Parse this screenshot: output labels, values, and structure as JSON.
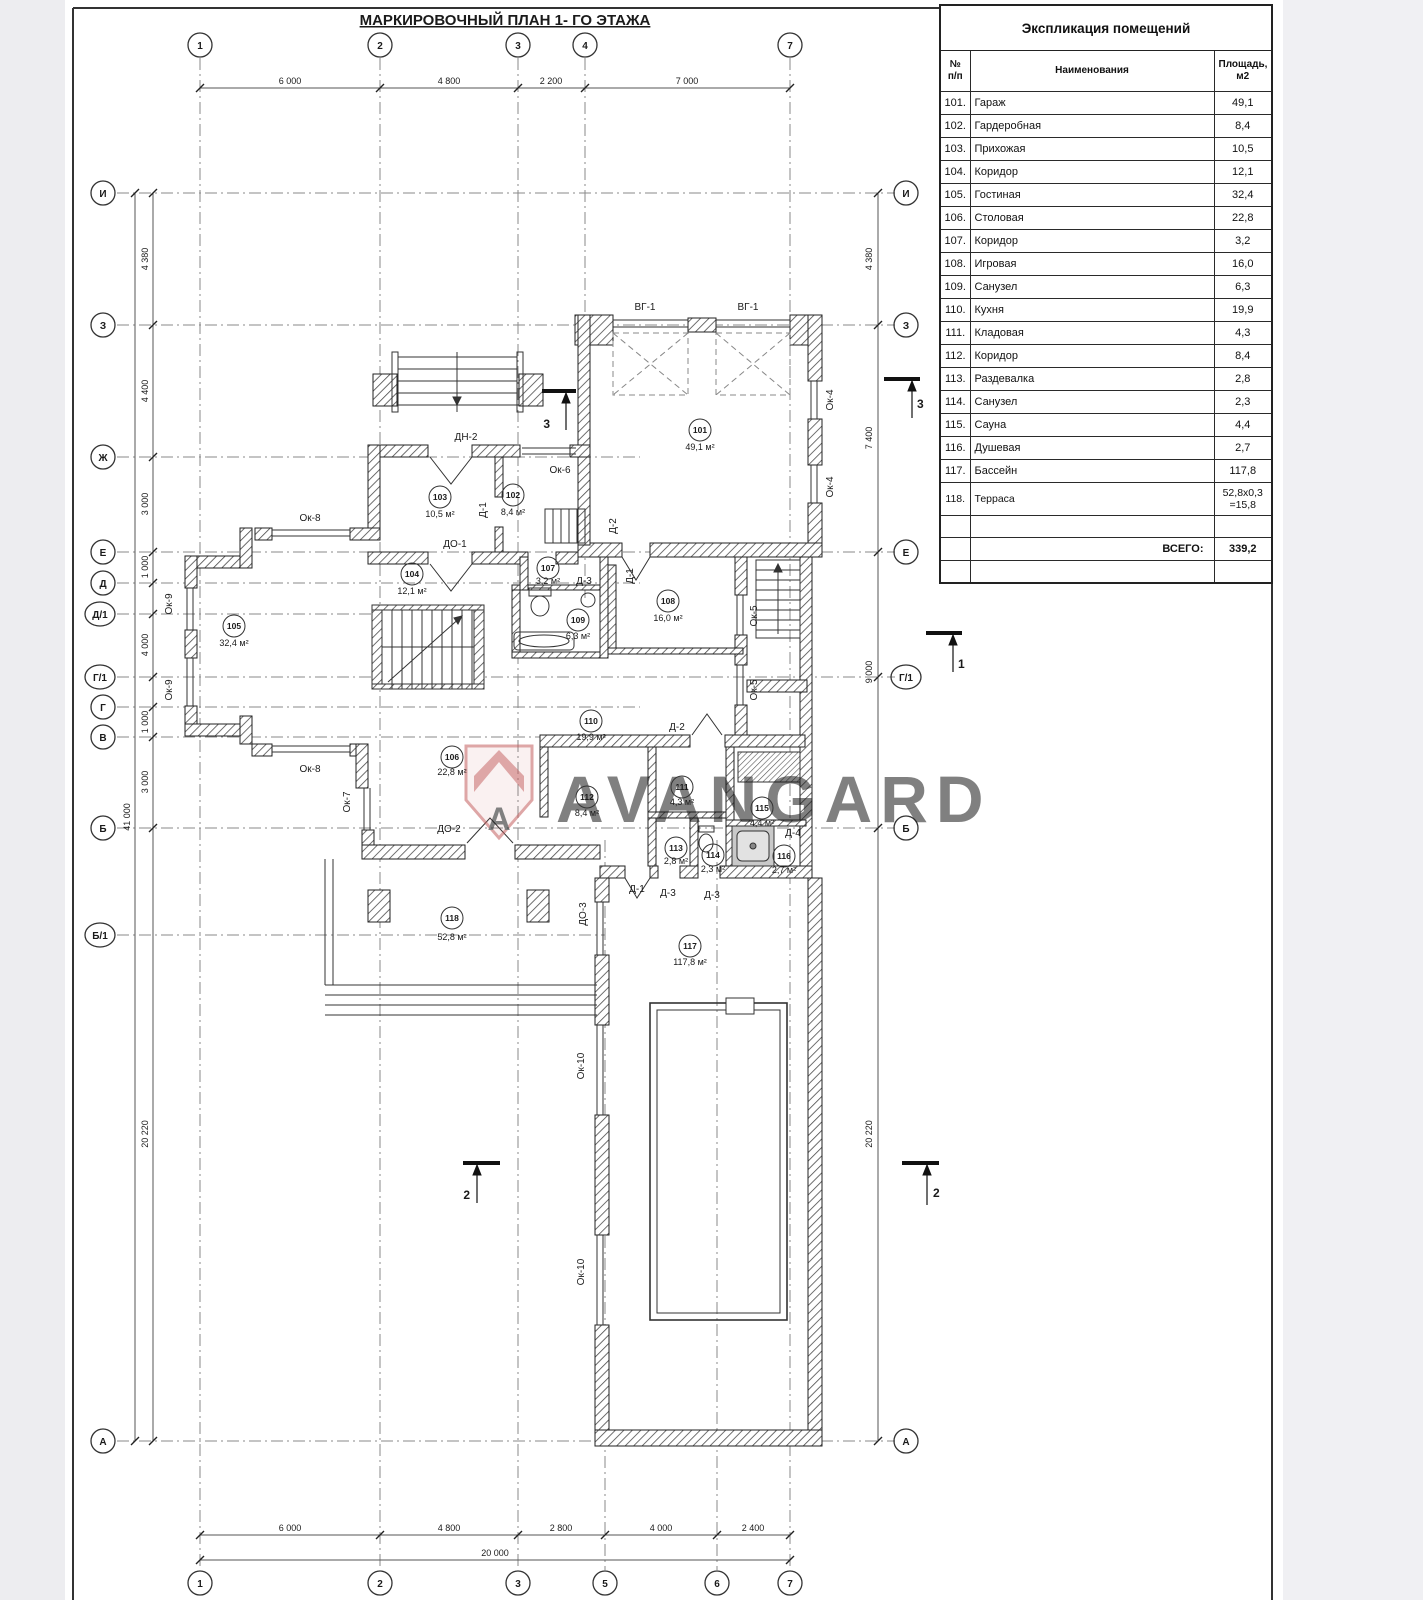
{
  "sheet": {
    "title": "МАРКИРОВОЧНЫЙ ПЛАН  1- ГО ЭТАЖА"
  },
  "watermark": {
    "text": "AVANGARD",
    "logo_letter": "А",
    "color": "#c45e5e"
  },
  "table": {
    "title": "Экспликация помещений",
    "headers": {
      "num": "№\nп/п",
      "name": "Наименования",
      "area": "Площадь,\nм2"
    },
    "rows": [
      {
        "num": "101.",
        "name": "Гараж",
        "area": "49,1"
      },
      {
        "num": "102.",
        "name": "Гардеробная",
        "area": "8,4"
      },
      {
        "num": "103.",
        "name": "Прихожая",
        "area": "10,5"
      },
      {
        "num": "104.",
        "name": "Коридор",
        "area": "12,1"
      },
      {
        "num": "105.",
        "name": "Гостиная",
        "area": "32,4"
      },
      {
        "num": "106.",
        "name": "Столовая",
        "area": "22,8"
      },
      {
        "num": "107.",
        "name": "Коридор",
        "area": "3,2"
      },
      {
        "num": "108.",
        "name": "Игровая",
        "area": "16,0"
      },
      {
        "num": "109.",
        "name": "Санузел",
        "area": "6,3"
      },
      {
        "num": "110.",
        "name": "Кухня",
        "area": "19,9"
      },
      {
        "num": "111.",
        "name": "Кладовая",
        "area": "4,3"
      },
      {
        "num": "112.",
        "name": "Коридор",
        "area": "8,4"
      },
      {
        "num": "113.",
        "name": "Раздевалка",
        "area": "2,8"
      },
      {
        "num": "114.",
        "name": "Санузел",
        "area": "2,3"
      },
      {
        "num": "115.",
        "name": "Сауна",
        "area": "4,4"
      },
      {
        "num": "116.",
        "name": "Душевая",
        "area": "2,7"
      },
      {
        "num": "117.",
        "name": "Бассейн",
        "area": "117,8"
      },
      {
        "num": "118.",
        "name": "Терраса",
        "area": "52,8х0,3\n=15,8"
      }
    ],
    "total_label": "ВСЕГО:",
    "total_value": "339,2"
  },
  "grid": {
    "top": [
      "1",
      "2",
      "3",
      "4",
      "7"
    ],
    "bottom": [
      "1",
      "2",
      "3",
      "5",
      "6",
      "7"
    ],
    "left": [
      "И",
      "З",
      "Ж",
      "Е",
      "Д",
      "Д/1",
      "Г/1",
      "Г",
      "В",
      "Б",
      "Б/1",
      "А"
    ],
    "right": [
      "И",
      "З",
      "Е",
      "Г/1",
      "Б",
      "А"
    ]
  },
  "dims": {
    "top": [
      "6 000",
      "4 800",
      "2 200",
      "7 000"
    ],
    "bottom": [
      "6 000",
      "4 800",
      "2 800",
      "4 000",
      "2 400"
    ],
    "bottom_total": "20 000",
    "left": [
      "4 380",
      "4 400",
      "3 000",
      "1 000",
      "4 000",
      "1 000",
      "3 000",
      "20 220"
    ],
    "left_total": "41 000",
    "right": [
      "4 380",
      "7 400",
      "9 000",
      "20 220"
    ]
  },
  "rooms": [
    {
      "num": "101",
      "area": "49,1 м²"
    },
    {
      "num": "102",
      "area": "8,4 м²"
    },
    {
      "num": "103",
      "area": "10,5 м²"
    },
    {
      "num": "104",
      "area": "12,1 м²"
    },
    {
      "num": "105",
      "area": "32,4 м²"
    },
    {
      "num": "106",
      "area": "22,8 м²"
    },
    {
      "num": "107",
      "area": "3,2 м²"
    },
    {
      "num": "108",
      "area": "16,0 м²"
    },
    {
      "num": "109",
      "area": "6,3 м²"
    },
    {
      "num": "110",
      "area": "19,9 м²"
    },
    {
      "num": "111",
      "area": "4,3 м²"
    },
    {
      "num": "112",
      "area": "8,4 м²"
    },
    {
      "num": "113",
      "area": "2,8 м²"
    },
    {
      "num": "114",
      "area": "2,3 м²"
    },
    {
      "num": "115",
      "area": "4,4 м²"
    },
    {
      "num": "116",
      "area": "2,7 м²"
    },
    {
      "num": "117",
      "area": "117,8 м²"
    },
    {
      "num": "118",
      "area": "52,8 м²"
    }
  ],
  "labels": {
    "vg1": "ВГ-1",
    "dn2": "ДН-2",
    "do1": "ДО-1",
    "do2": "ДО-2",
    "do3": "ДО-3",
    "d1": "Д-1",
    "d2": "Д-2",
    "d3": "Д-3",
    "d4": "Д-4",
    "ok4": "Ок-4",
    "ok5": "Ок-5",
    "ok6": "Ок-6",
    "ok7": "Ок-7",
    "ok8": "Ок-8",
    "ok9": "Ок-9",
    "ok10": "Ок-10"
  },
  "sections": {
    "s1": "1",
    "s2": "2",
    "s3": "3"
  }
}
